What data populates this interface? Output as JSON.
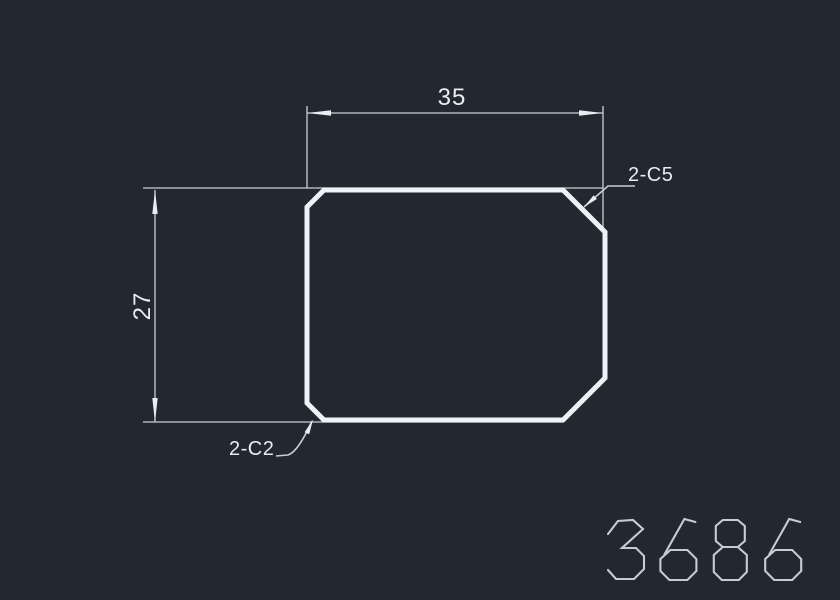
{
  "canvas": {
    "background": "#232830",
    "outline_color": "#edf2f6",
    "thin_line_color": "#c9ced3",
    "text_color": "#e9edf1",
    "part_number_color": "#c6ccd4"
  },
  "drawing": {
    "dim_width": {
      "value": "35"
    },
    "dim_height": {
      "value": "27"
    },
    "chamfer_top_right": {
      "label": "2-C5"
    },
    "chamfer_bottom_left": {
      "label": "2-C2"
    },
    "part_number": {
      "text": "3686"
    }
  }
}
